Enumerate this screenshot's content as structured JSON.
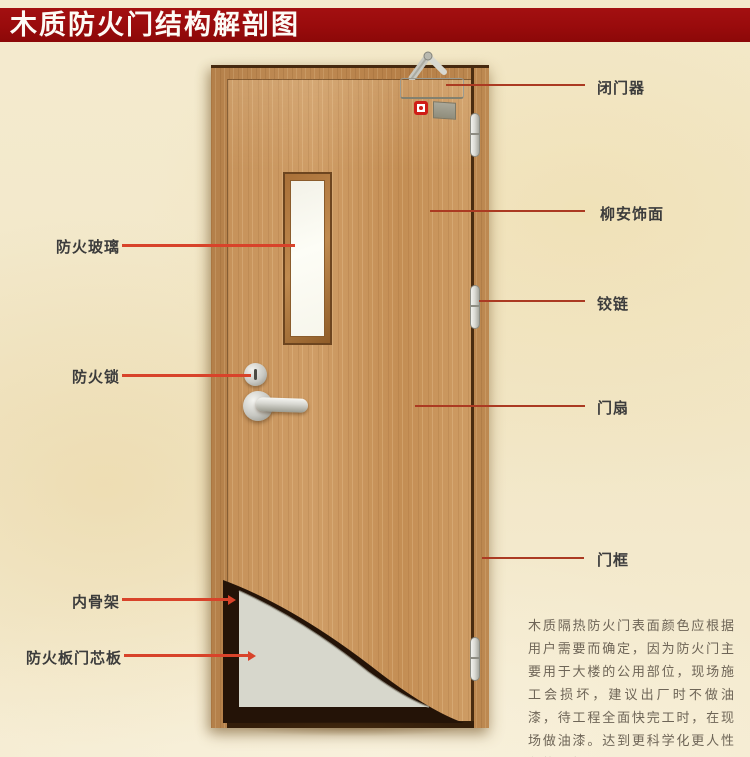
{
  "title": "木质防火门结构解剖图",
  "colors": {
    "banner_red": "#990b0c",
    "background_beige": "#f2e7c8",
    "leader_left": "#d8432a",
    "leader_right": "#ab3a22",
    "door_wood": "#c6925a",
    "frame_wood": "#b4804a",
    "skeleton_dark": "#241307",
    "core_gray": "#d7d7cc",
    "indicator_red": "#cf1d16"
  },
  "labels": {
    "left": [
      {
        "text": "防火玻璃"
      },
      {
        "text": "防火锁"
      },
      {
        "text": "内骨架"
      },
      {
        "text": "防火板门芯板"
      }
    ],
    "right": [
      {
        "text": "闭门器"
      },
      {
        "text": "柳安饰面"
      },
      {
        "text": "铰链"
      },
      {
        "text": "门扇"
      },
      {
        "text": "门框"
      }
    ]
  },
  "description": "木质隔热防火门表面颜色应根据用户需要而确定，因为防火门主要用于大楼的公用部位，现场施工会损坏，建议出厂时不做油漆，待工程全面快完工时，在现场做油漆。达到更科学化更人性化的服务。"
}
